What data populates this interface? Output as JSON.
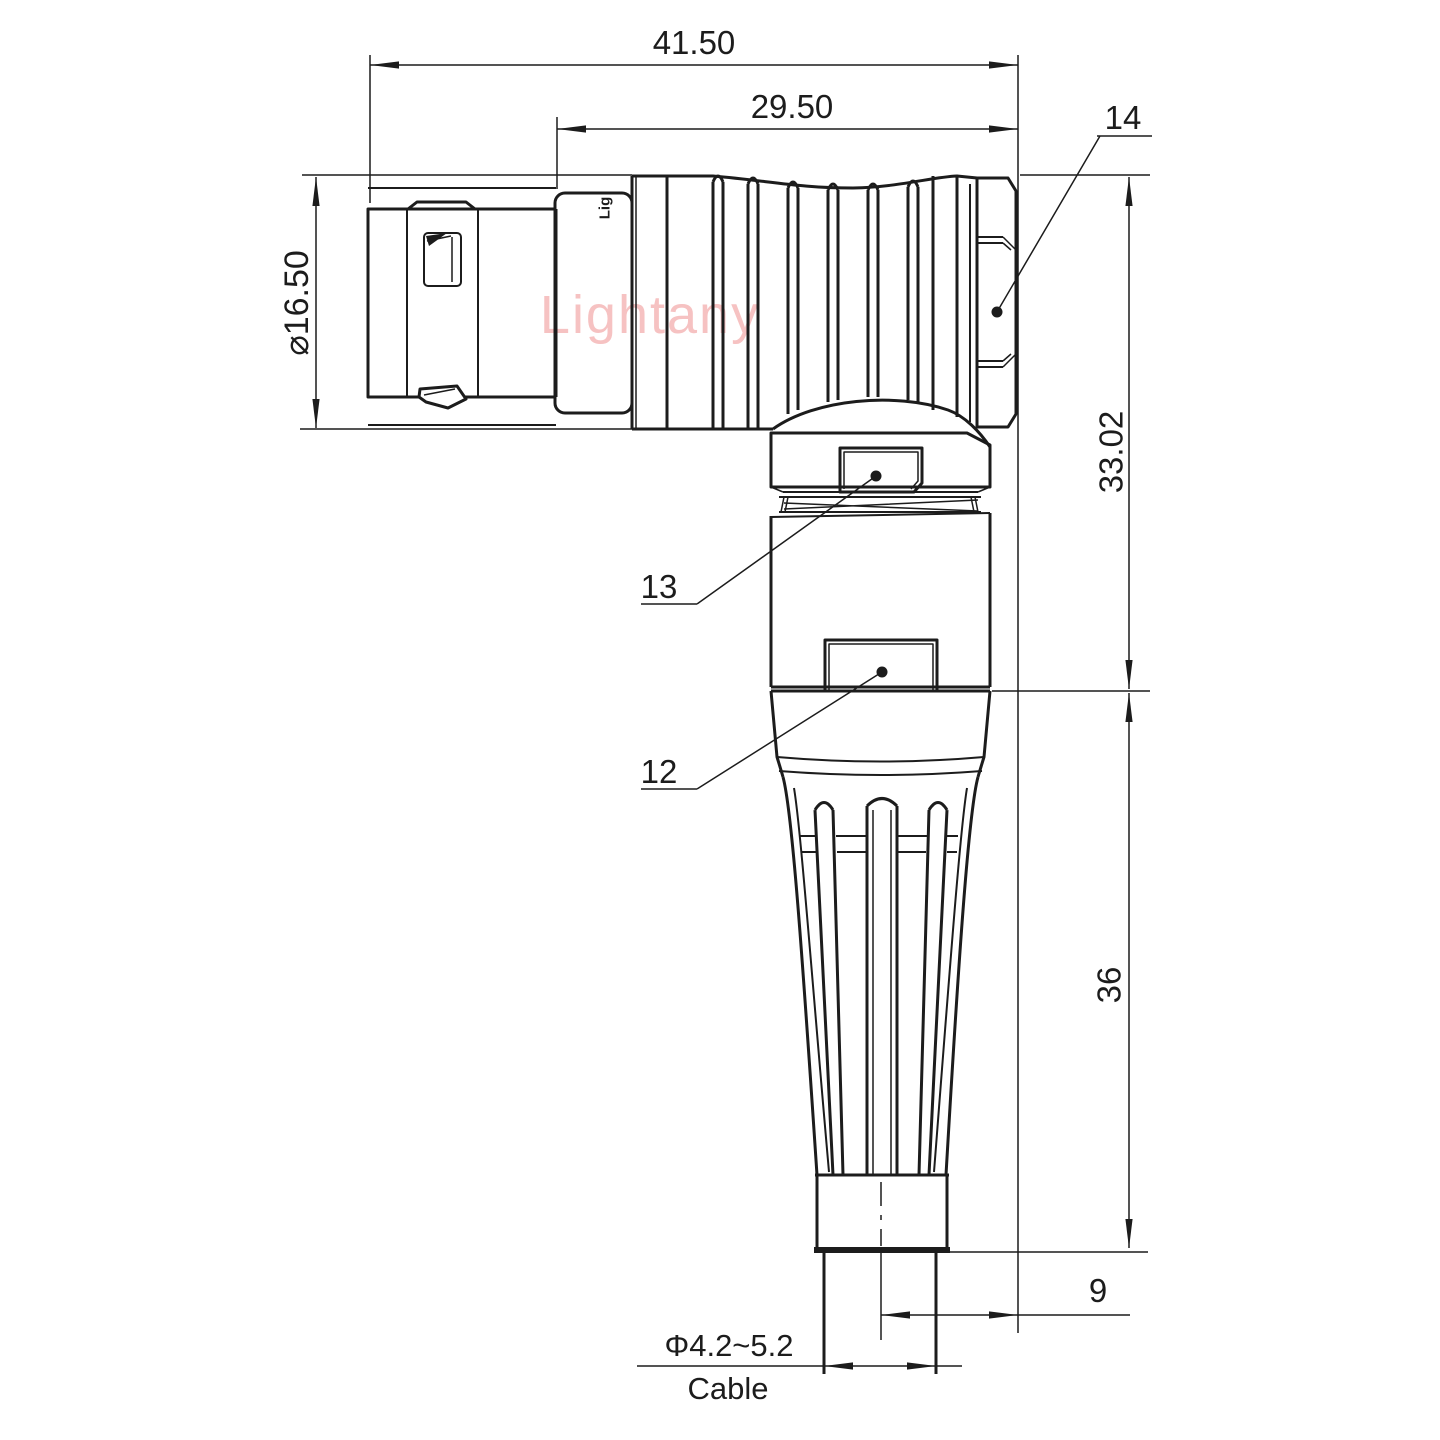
{
  "drawing": {
    "watermark": "Lightany",
    "brand_fragment": "Lig",
    "colors": {
      "line": "#1c1c1c",
      "watermark": "#f6c2c2",
      "background": "#ffffff"
    },
    "dimensions": {
      "overall_length": "41.50",
      "rear_length": "29.50",
      "shell_diameter": "⌀16.50",
      "elbow_height_upper": "33.02",
      "elbow_height_lower": "36",
      "cable_offset": "9",
      "cable_diameter": "Φ4.2~5.2",
      "cable_label": "Cable"
    },
    "part_references": {
      "coupling_nut": "14",
      "collar_plate": "13",
      "housing_plate": "12"
    }
  }
}
